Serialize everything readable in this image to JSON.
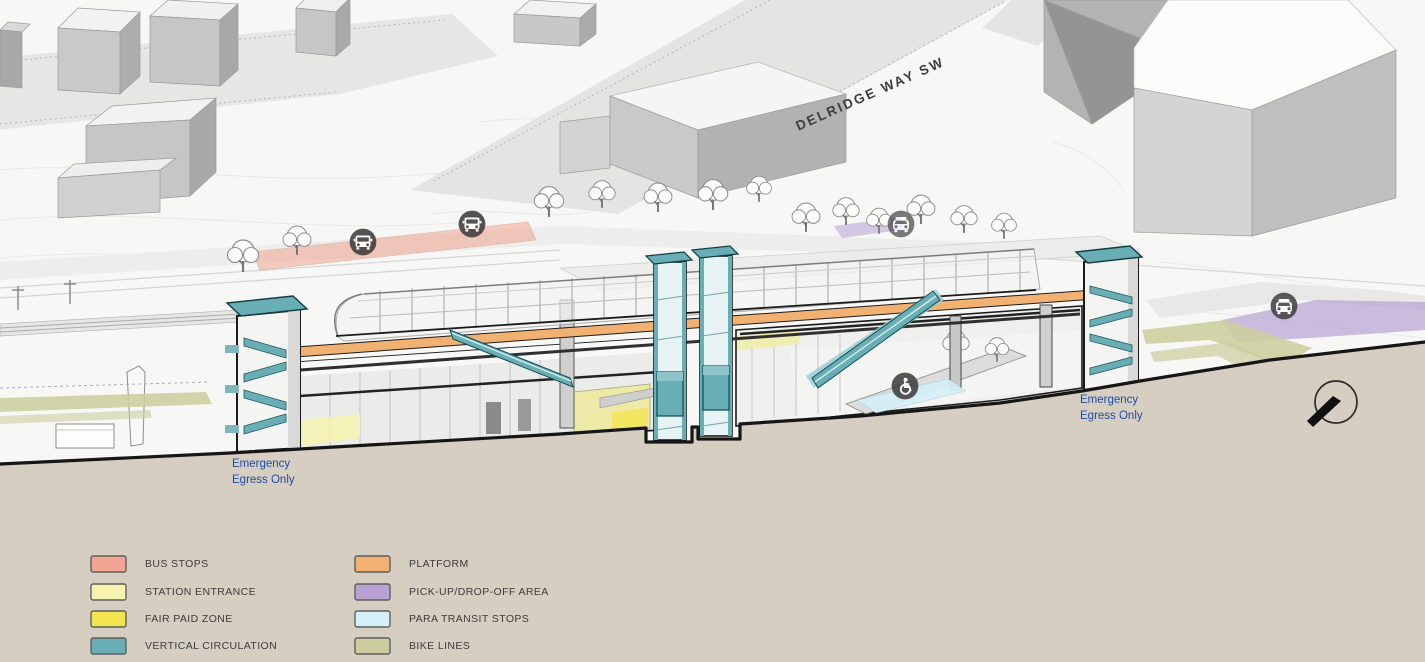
{
  "street": {
    "label": "DELRIDGE WAY SW"
  },
  "labels": {
    "emergency_left": {
      "line1": "Emergency",
      "line2": "Egress Only"
    },
    "emergency_right": {
      "line1": "Emergency",
      "line2": "Egress Only"
    }
  },
  "legend": {
    "items": [
      {
        "label": "BUS STOPS",
        "color": "#F2A593"
      },
      {
        "label": "STATION ENTRANCE",
        "color": "#F7F3B0"
      },
      {
        "label": "FAIR PAID ZONE",
        "color": "#F2E44E"
      },
      {
        "label": "VERTICAL CIRCULATION",
        "color": "#68AEB4"
      },
      {
        "label": "PLATFORM",
        "color": "#F0B173"
      },
      {
        "label": "PICK-UP/DROP-OFF AREA",
        "color": "#B7A2D3"
      },
      {
        "label": "PARA TRANSIT STOPS",
        "color": "#D5F0F8"
      },
      {
        "label": "BIKE LINES",
        "color": "#CCCEA0"
      }
    ]
  },
  "icons": {
    "bus": "bus-icon",
    "car": "car-icon",
    "wheelchair": "wheelchair-icon",
    "north_arrow": "north-arrow-icon"
  },
  "colors": {
    "ground": "#D6CEC0",
    "terrain": "#F7F7F5",
    "outline": "#161616",
    "teal": "#68AEB4",
    "teal_light": "#9DCBD0",
    "platform_orange": "#F0B173",
    "bus_salmon": "#F2A593",
    "purple": "#B7A2D3",
    "para_blue": "#D5F0F8",
    "bike_olive": "#CCCEA0",
    "entrance_yellow": "#F7F3B0",
    "paid_yellow": "#F2E44E",
    "label_blue": "#1C4DA6"
  }
}
